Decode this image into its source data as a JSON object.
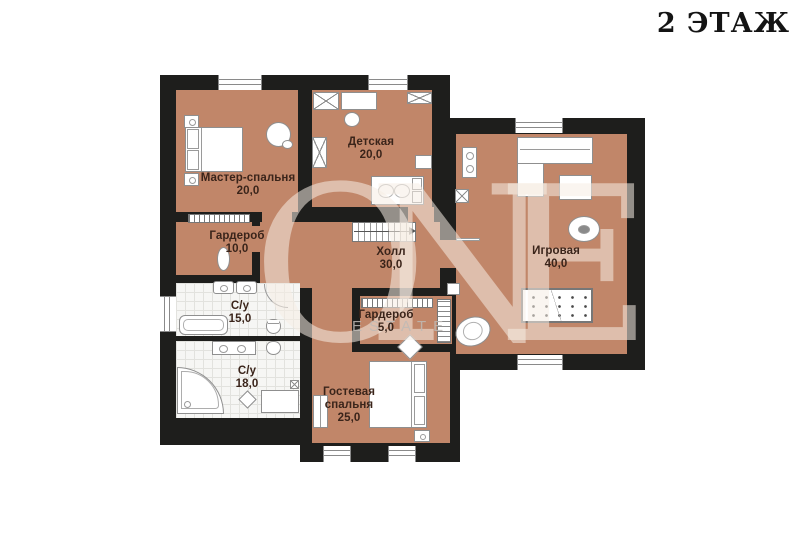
{
  "title": "2 ЭТАЖ",
  "watermark": {
    "brand": "ONE",
    "sub": "ESTATE"
  },
  "colors": {
    "floor": "#c18669",
    "wall": "#1e1e1c",
    "bath_floor": "#f6f6f4",
    "label": "#3a241a"
  },
  "plan": {
    "floor_number": "2",
    "rooms": [
      {
        "id": "master",
        "name": "Мастер-спальня",
        "area": "20,0"
      },
      {
        "id": "detskaya",
        "name": "Детская",
        "area": "20,0"
      },
      {
        "id": "igrovaya",
        "name": "Игровая",
        "area": "40,0"
      },
      {
        "id": "hall",
        "name": "Холл",
        "area": "30,0"
      },
      {
        "id": "wardrobe10",
        "name": "Гардероб",
        "area": "10,0"
      },
      {
        "id": "wardrobe5",
        "name": "Гардероб",
        "area": "5,0"
      },
      {
        "id": "su15",
        "name": "С/у",
        "area": "15,0"
      },
      {
        "id": "su18",
        "name": "С/у",
        "area": "18,0"
      },
      {
        "id": "guest",
        "name": "Гостевая спальня",
        "area": "25,0"
      }
    ]
  },
  "icons": [
    "window",
    "door-opening",
    "staircase-icon",
    "bed-icon",
    "wardrobe-icon",
    "hanger-rack-icon",
    "sofa-icon",
    "coffee-table-icon",
    "billiard-table-icon",
    "bean-bag-icon",
    "egg-chair-icon",
    "bathtub-icon",
    "corner-bathtub-icon",
    "sink-icon",
    "toilet-icon",
    "nightstand-icon",
    "armchair-icon",
    "duct-icon",
    "shelf-icon"
  ]
}
